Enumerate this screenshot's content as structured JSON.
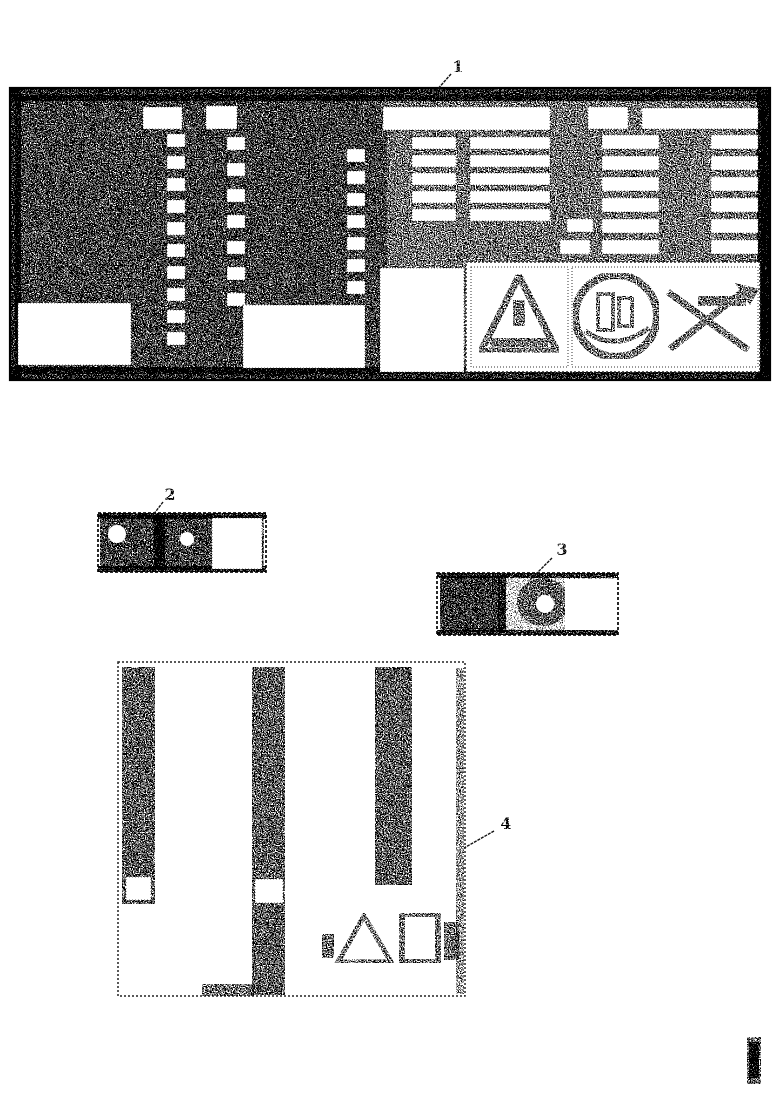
{
  "page": {
    "paper_color": "#ffffff",
    "ink_color": "#000000"
  },
  "callouts": [
    {
      "number": "1"
    },
    {
      "number": "2"
    },
    {
      "number": "3"
    },
    {
      "number": "4"
    }
  ],
  "icons": {
    "plate_pictograms": [
      "warning-triangle-icon",
      "circular-machine-symbol-icon",
      "crossed-out-no-symbol-icon"
    ],
    "label4_pictograms": [
      "warning-triangle-icon",
      "placard-box-icon"
    ],
    "figure_code": "vertical-illegible-code"
  }
}
